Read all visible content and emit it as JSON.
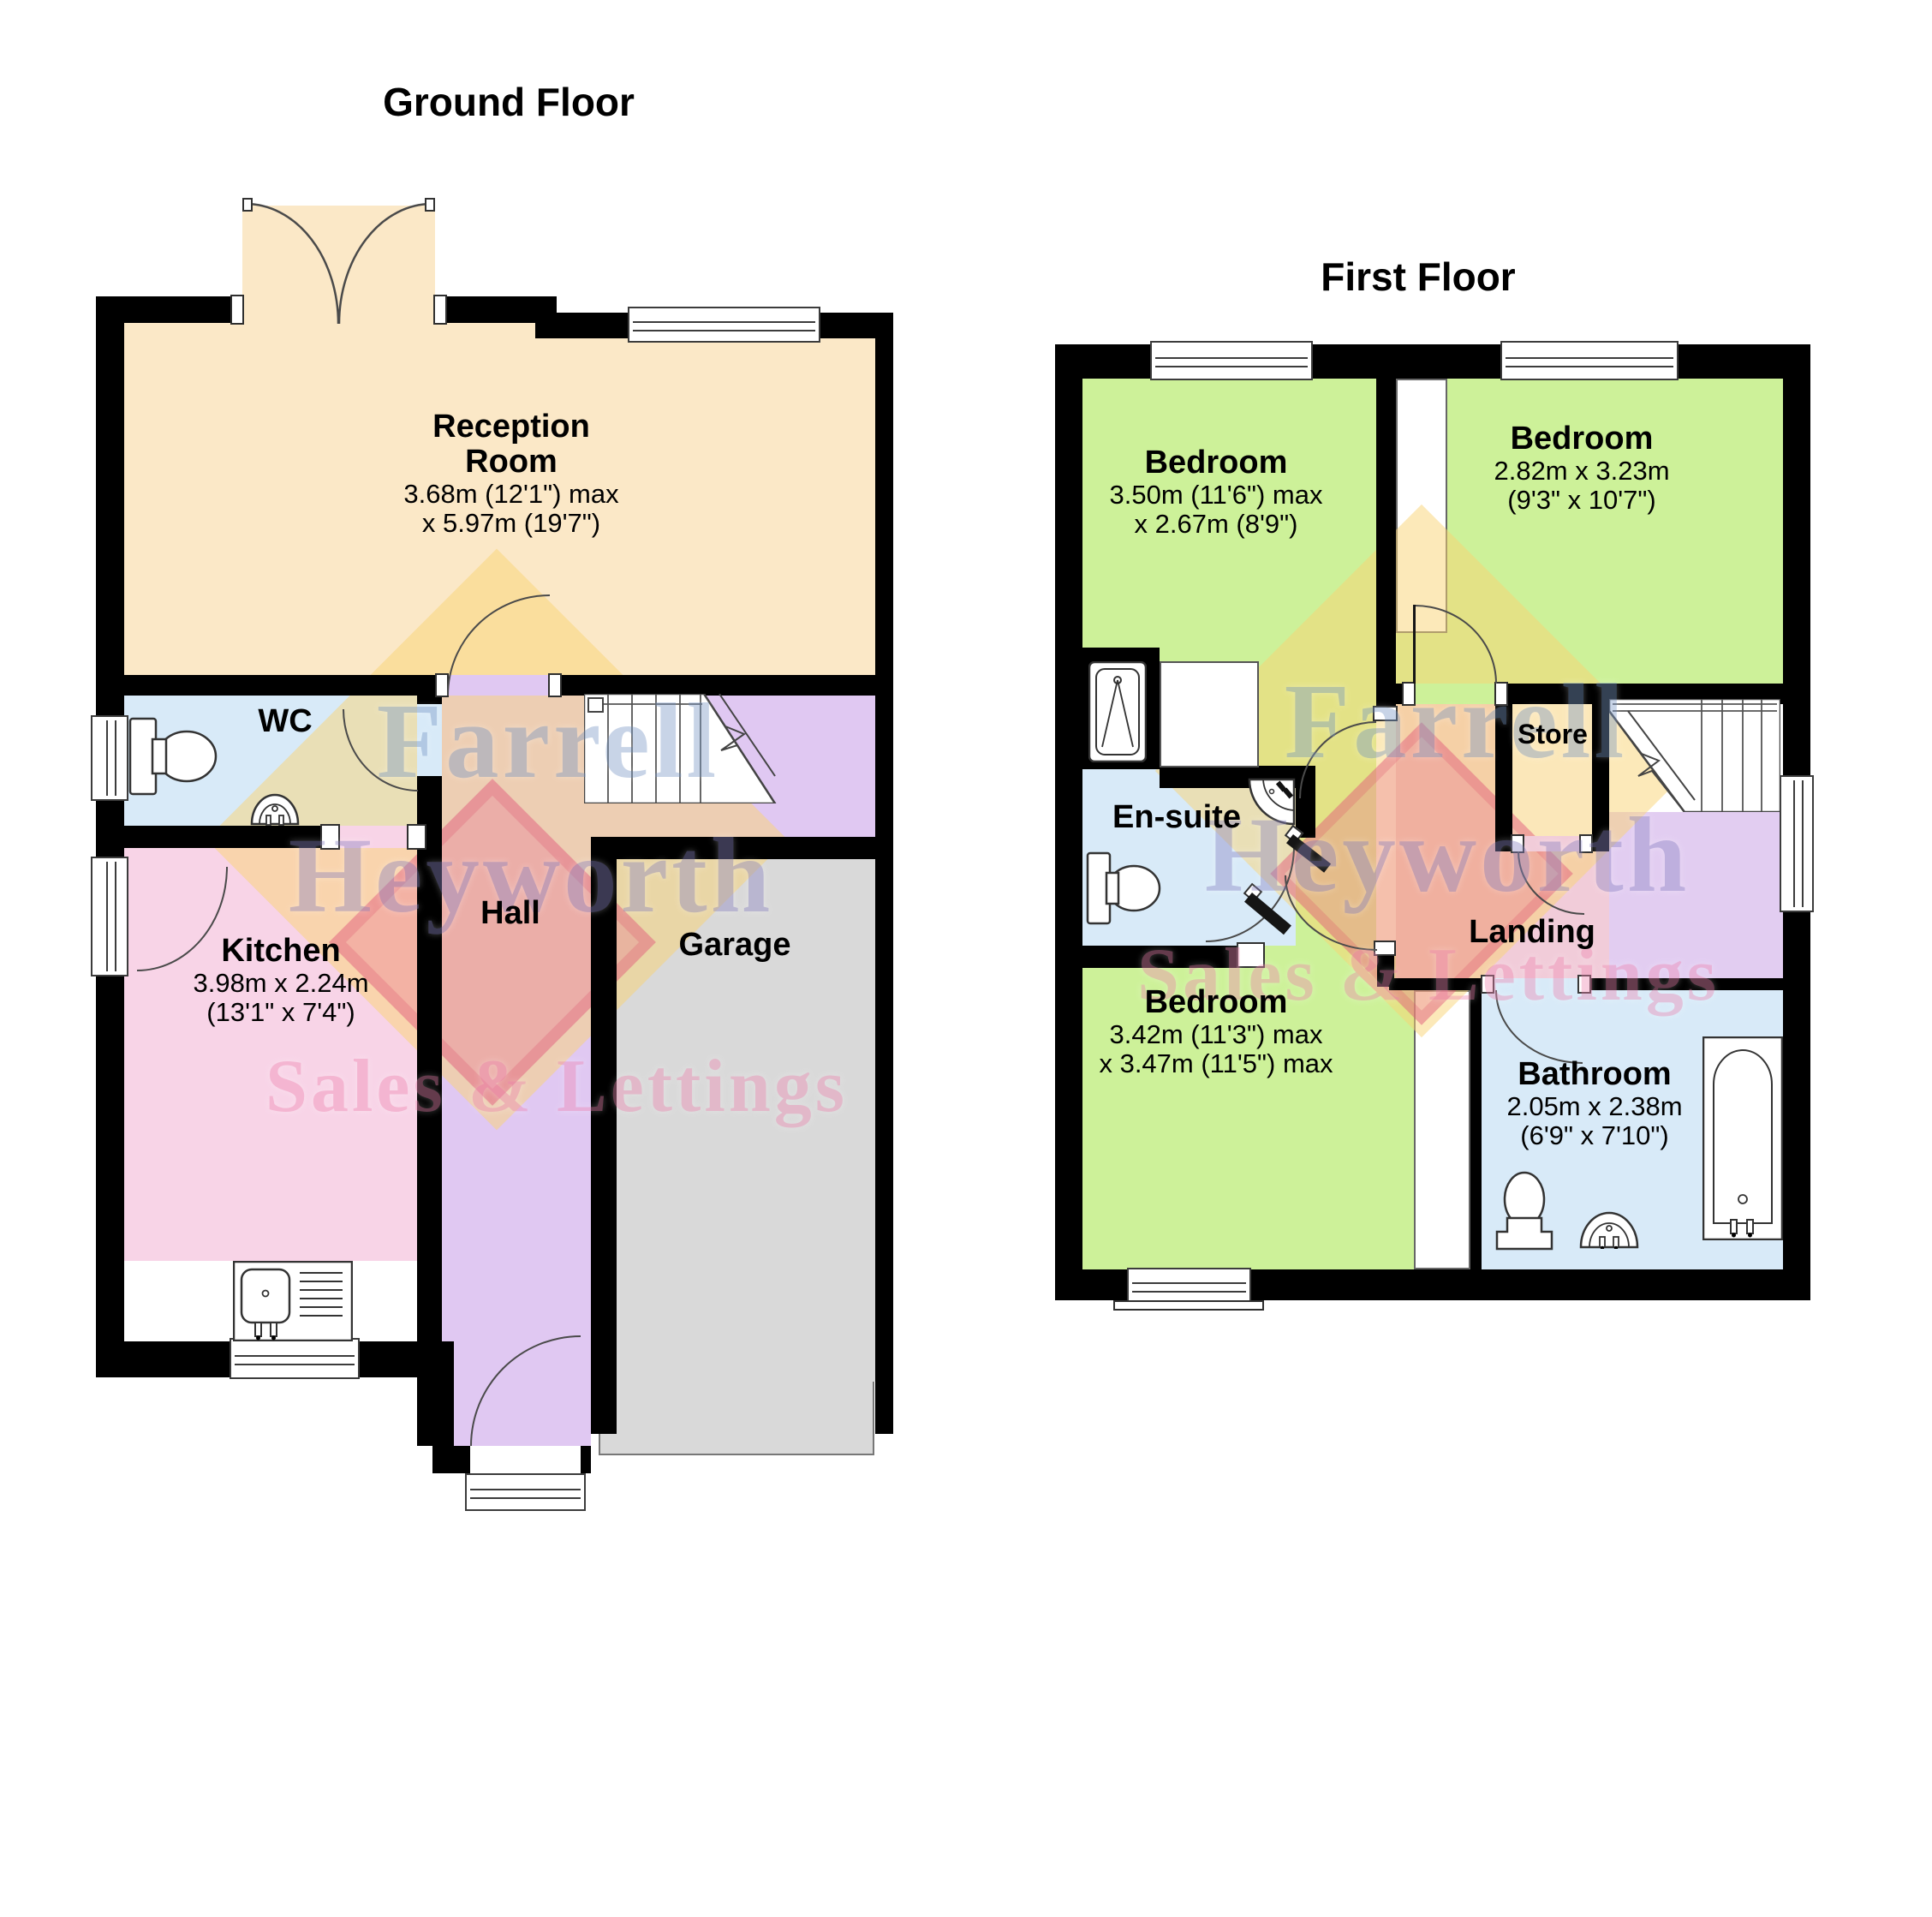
{
  "ground_floor": {
    "title": "Ground Floor",
    "rooms": {
      "reception": {
        "name_line1": "Reception",
        "name_line2": "Room",
        "dims_line1": "3.68m (12'1\") max",
        "dims_line2": "x 5.97m (19'7\")"
      },
      "wc": {
        "name": "WC"
      },
      "hall": {
        "name": "Hall"
      },
      "kitchen": {
        "name": "Kitchen",
        "dims_line1": "3.98m x 2.24m",
        "dims_line2": "(13'1\" x 7'4\")"
      },
      "garage": {
        "name": "Garage"
      }
    }
  },
  "first_floor": {
    "title": "First Floor",
    "rooms": {
      "bedroom_top_left": {
        "name": "Bedroom",
        "dims_line1": "3.50m (11'6\") max",
        "dims_line2": "x 2.67m (8'9\")"
      },
      "bedroom_top_right": {
        "name": "Bedroom",
        "dims_line1": "2.82m x 3.23m",
        "dims_line2": "(9'3\" x 10'7\")"
      },
      "ensuite": {
        "name": "En-suite"
      },
      "store": {
        "name": "Store"
      },
      "landing": {
        "name": "Landing"
      },
      "bedroom_bottom": {
        "name": "Bedroom",
        "dims_line1": "3.42m (11'3\") max",
        "dims_line2": "x 3.47m (11'5\") max"
      },
      "bathroom": {
        "name": "Bathroom",
        "dims_line1": "2.05m x 2.38m",
        "dims_line2": "(6'9\" x 7'10\")"
      }
    }
  },
  "watermark": {
    "line1": "Farrell",
    "line2": "Heyworth",
    "line3": "Sales & Lettings"
  },
  "palette": {
    "wall": "#000000",
    "reception": "#fbe8c7",
    "kitchen": "#f8d4e7",
    "hall": "#e0c8f2",
    "wet_room_blue": "#d8eaf8",
    "bedroom_green": "#cdf199",
    "landing_pink": "#f1ccd9",
    "landing_lilac": "#e2cdf1",
    "garage_grey": "#d9d9d9",
    "watermark_yellow": "#f8d470",
    "watermark_blue": "#7d9bc7",
    "watermark_purple": "#8e88c4",
    "watermark_pink": "#ef8cb5"
  }
}
